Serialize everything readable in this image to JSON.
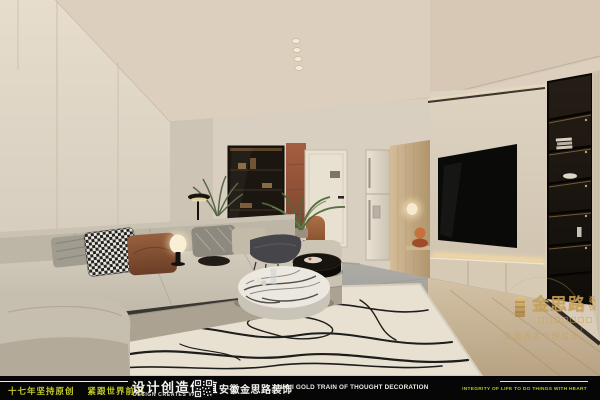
{
  "brand_colors": {
    "accent_yellow": "#c2c92d",
    "gold": "#cca356",
    "bar_bg": "#060606"
  },
  "bottom_bar": {
    "slogan_left_1": "十七年坚持原创",
    "slogan_left_2": "紧跟世界前沿",
    "center_cn": "设计创造价值",
    "center_en": "DESIGN CREATES VALUE",
    "company_cn": "安徽金思路装饰",
    "company_en": "ANHUI GOLD TRAIN OF THOUGHT DECORATION",
    "right_en": "INTEGRITY OF LIFE TO DO THINGS WITH HEART"
  },
  "watermark": {
    "brand_cn": "金思路",
    "brand_tag_1": "装",
    "brand_tag_2": "饰",
    "sub_line": "安徽肯古千想设计"
  },
  "scene": {
    "type": "interior-design-render",
    "room": "modern living room: beige panel walls, wood-slat accent strip, L-shaped greige sectional sofa, round marble coffee tables, patterned cream rug, recessed TV wall with LED strips, black display shelving, dining nook with leather chairs, terracotta accent panel, door, fridge, plants and lamps"
  }
}
